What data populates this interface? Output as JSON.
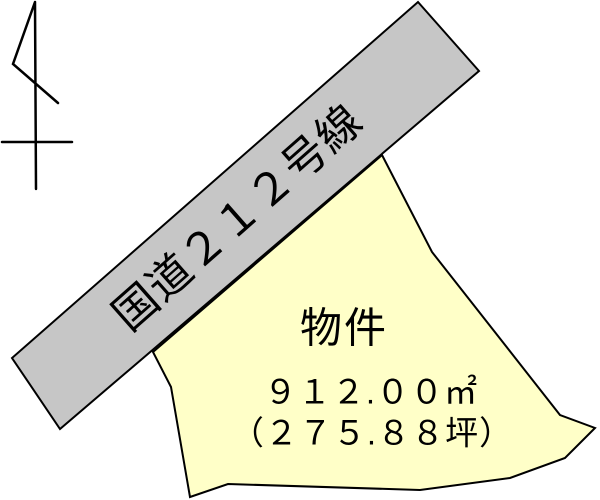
{
  "map": {
    "road": {
      "label": "国道２１２号線"
    },
    "parcel": {
      "name": "物件",
      "area_m2": "９１２.００㎡",
      "area_tsubo": "（２７５.８８坪）"
    },
    "symbols": {
      "north_arrow": "north-arrow"
    },
    "colors": {
      "road_fill": "#c6c6c6",
      "parcel_fill": "#ffffc8",
      "outline": "#000000",
      "background": "#ffffff"
    }
  }
}
